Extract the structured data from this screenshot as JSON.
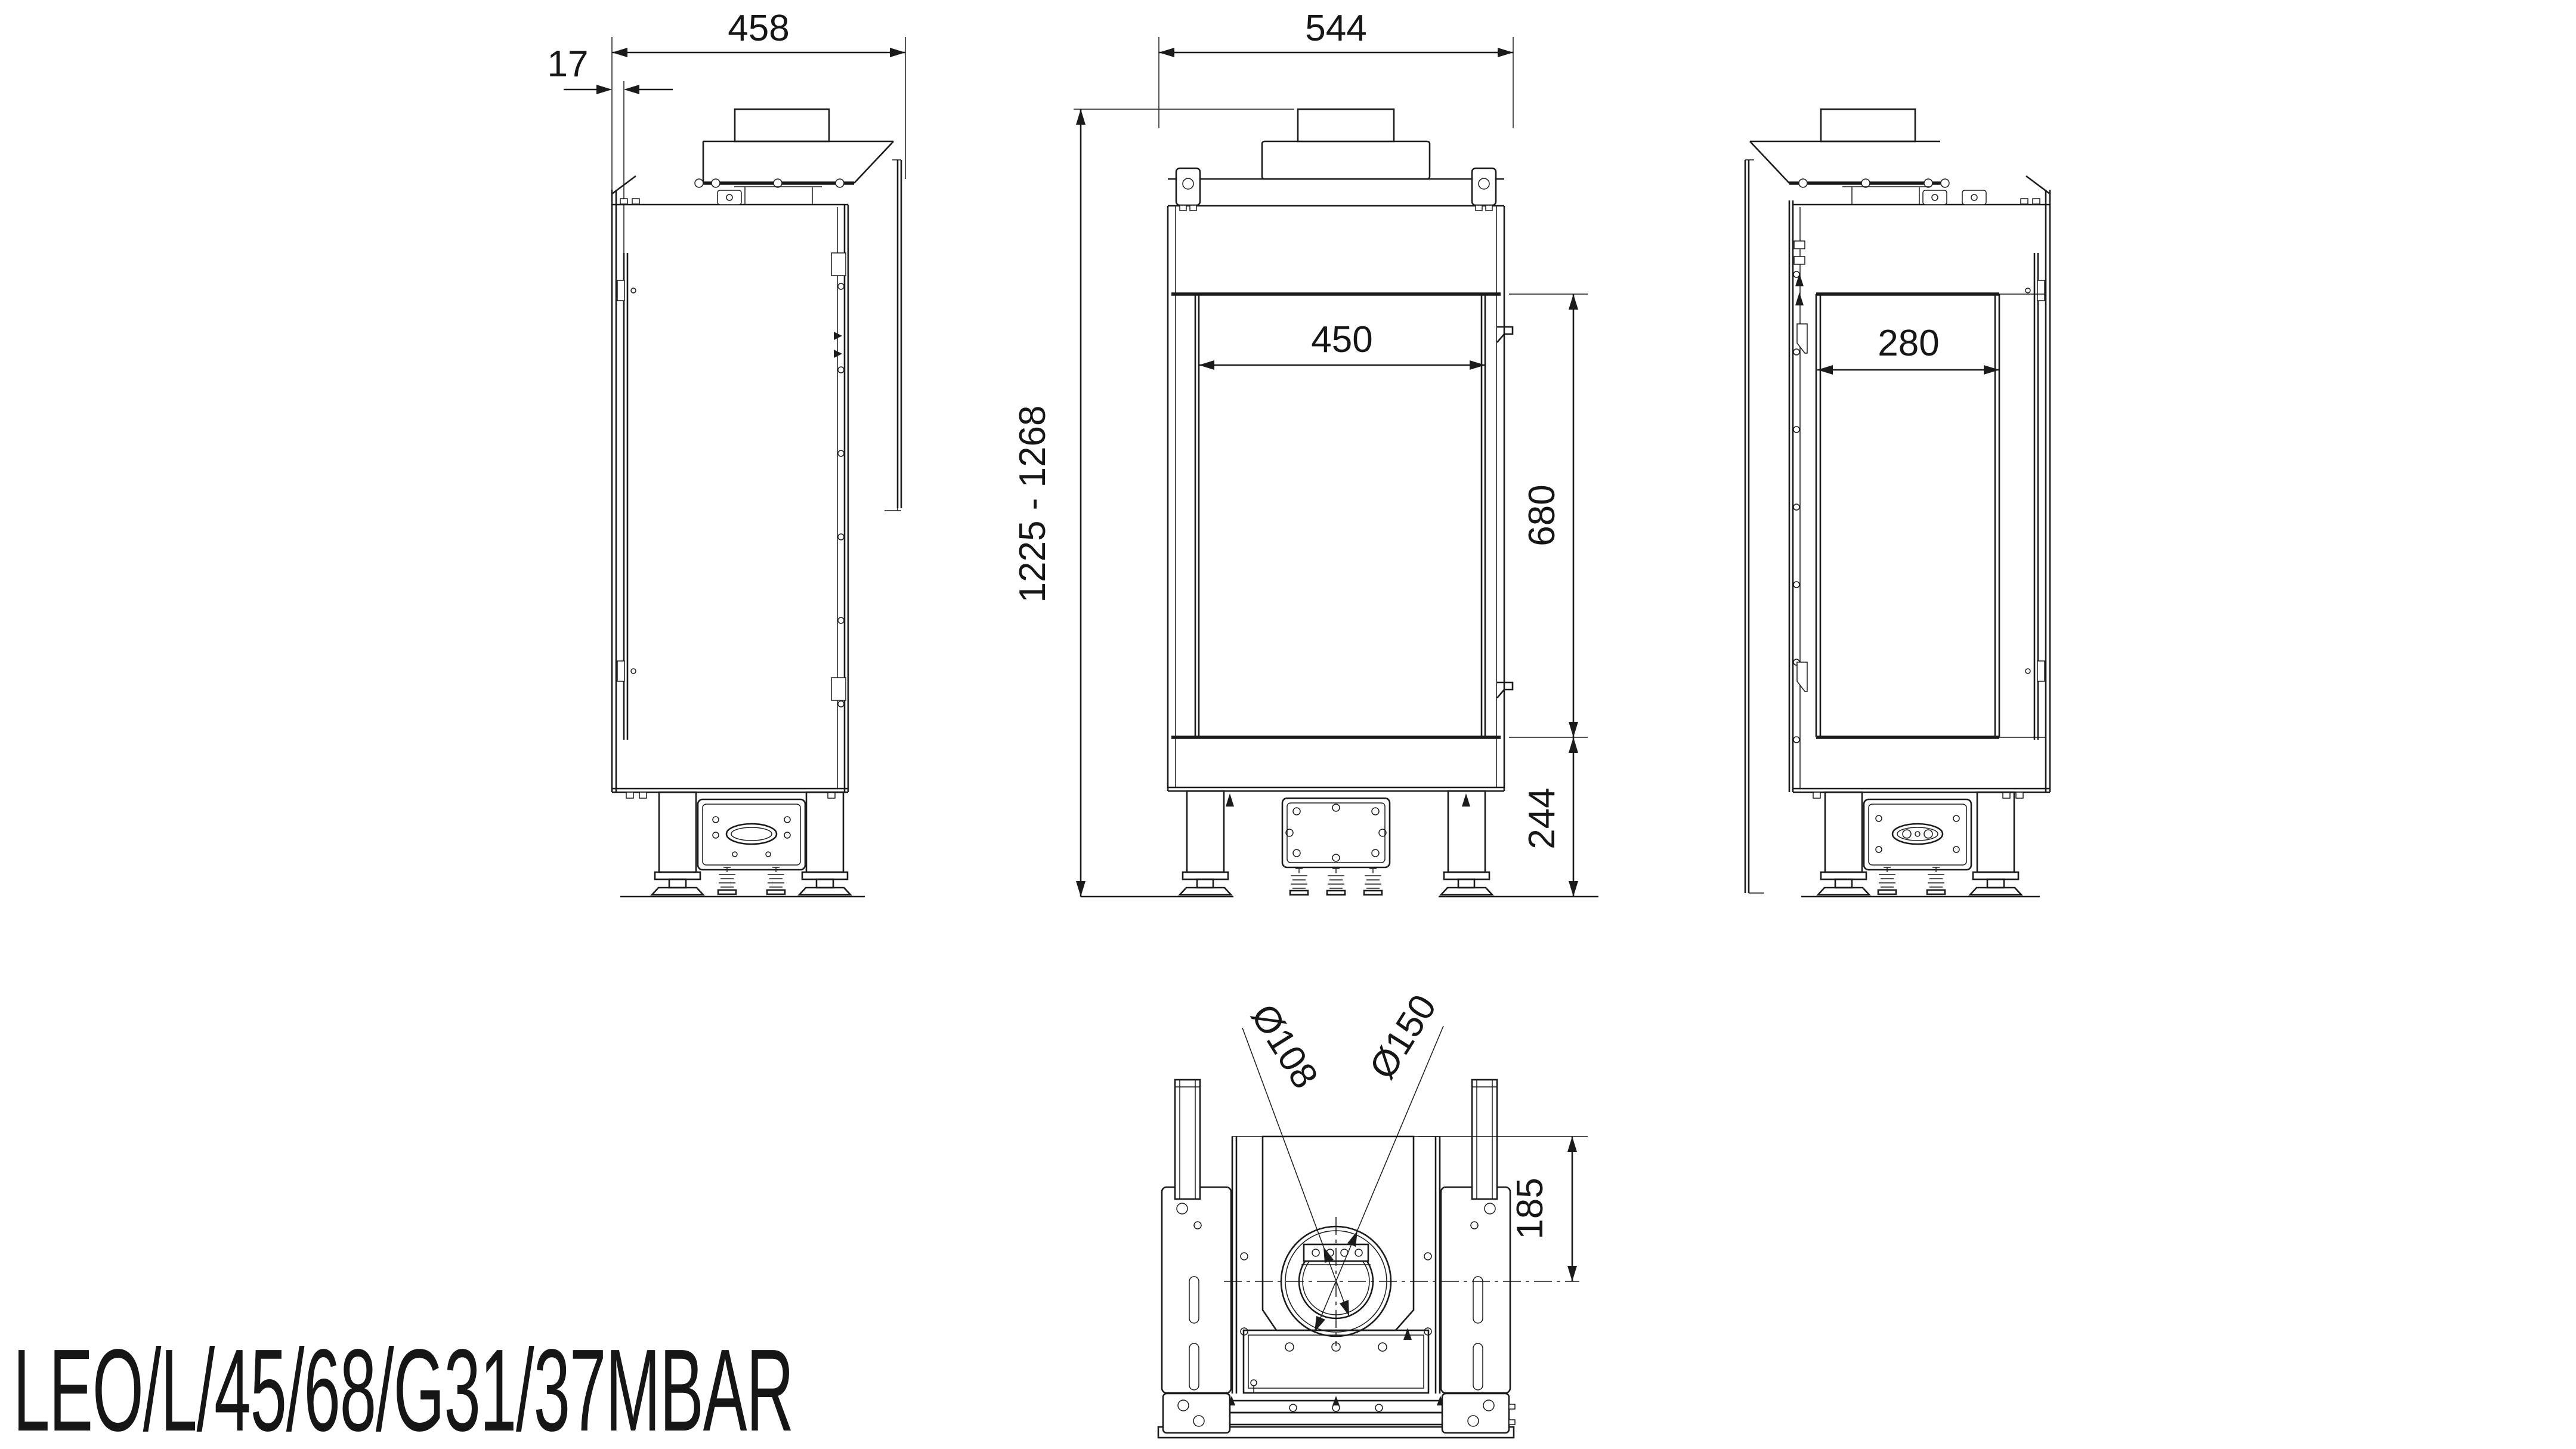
{
  "title": "LEO/L/45/68/G31/37MBAR",
  "dims": {
    "side_right": {
      "total_depth": "458",
      "glass_offset": "17"
    },
    "front": {
      "total_width": "544",
      "glass_width": "450",
      "glass_height": "680",
      "base_height": "244",
      "overall_height": "1225 - 1268"
    },
    "side_left": {
      "glass_depth": "280"
    },
    "bottom": {
      "flue_inner": "Ø108",
      "flue_outer": "Ø150",
      "flue_offset": "185"
    }
  },
  "colors": {
    "line": "#1b1b1b",
    "background": "#ffffff"
  }
}
